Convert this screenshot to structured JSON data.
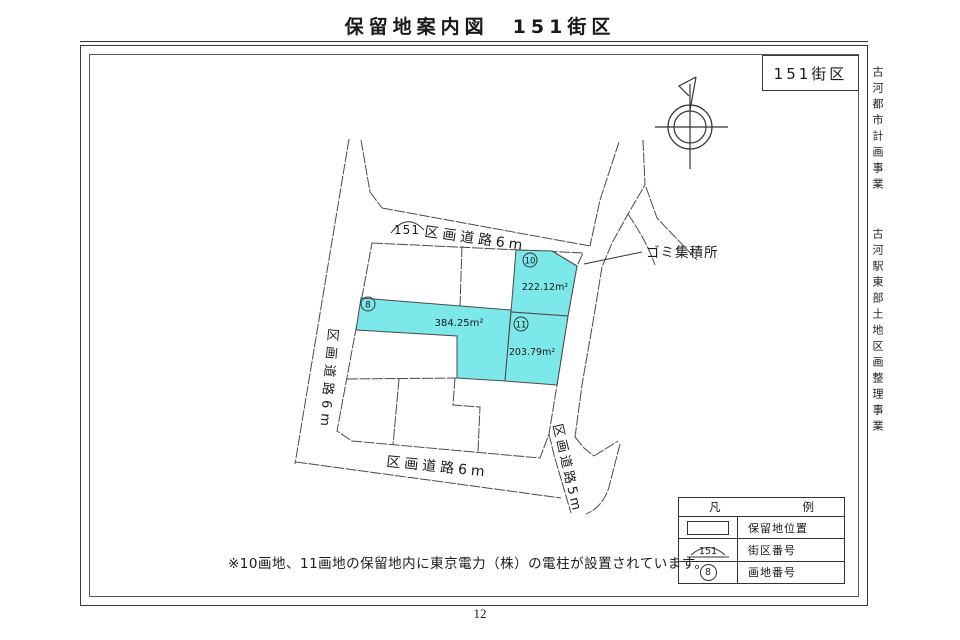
{
  "page": {
    "title": "保留地案内図　151街区",
    "page_number": "12",
    "note": "※10画地、11画地の保留地内に東京電力（株）の電柱が設置されています。"
  },
  "header_box": {
    "label": "151街区"
  },
  "side_text": {
    "line1": "古河都市計画事業",
    "line2": "古河駅東部土地区画整理事業"
  },
  "map": {
    "roads": {
      "top": "区画道路6m",
      "left": "区画道路6m",
      "bottom": "区画道路6m",
      "right": "区画道路5m"
    },
    "block_number": "151",
    "garbage_label": "ゴミ集積所",
    "parcels": [
      {
        "id": "8",
        "area": "384.25m²"
      },
      {
        "id": "10",
        "area": "222.12m²"
      },
      {
        "id": "11",
        "area": "203.79m²"
      }
    ]
  },
  "legend": {
    "title_left": "凡",
    "title_right": "例",
    "rows": [
      {
        "label": "保留地位置"
      },
      {
        "symbol": "151",
        "label": "街区番号"
      },
      {
        "symbol": "8",
        "label": "画地番号"
      }
    ]
  },
  "colors": {
    "reserved_fill": "#7CE8E9",
    "line": "#4a4a4a"
  }
}
